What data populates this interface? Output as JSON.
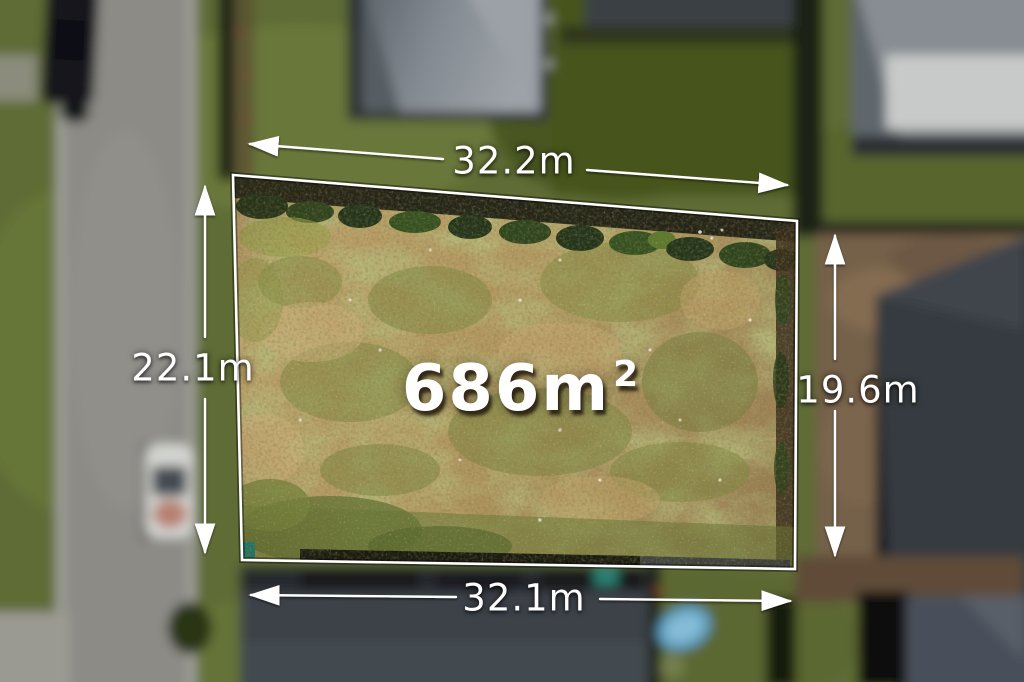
{
  "photo": {
    "kind": "aerial-drone-photo-of-vacant-land-lot",
    "area_label": {
      "value": "686m",
      "superscript": "2"
    },
    "dimensions": {
      "top": "32.2m",
      "left": "22.1m",
      "right": "19.6m",
      "bottom": "32.1m"
    },
    "colors": {
      "overlay_line": "#ffffff",
      "overlay_text": "#ffffff",
      "lot_dirt": "#b2985f",
      "lot_weeds": "#7c8740",
      "surrounding_grass": "#5f6c34",
      "road": "#8c8b86",
      "roof_dark": "#3e434a"
    }
  }
}
